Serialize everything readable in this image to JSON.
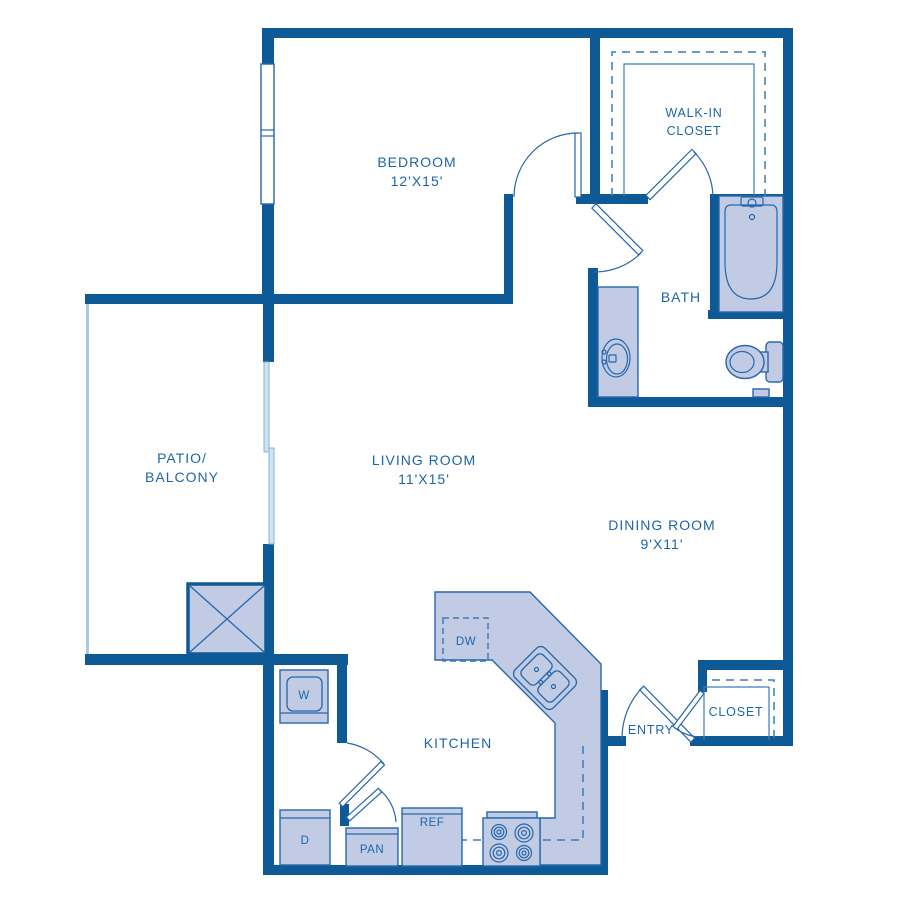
{
  "plan_title": "One bedroom apartment floor plan",
  "colors": {
    "wall": "#0e5a96",
    "fixture_fill": "#c1cbe4",
    "fixture_stroke": "#2767ab",
    "label_text": "#1c66ab",
    "dashed_line": "#3f7cb6",
    "railing": "#abc8de",
    "glass": "#cfe3f2",
    "glass_edge": "#86b3d2"
  },
  "rooms": {
    "bedroom": {
      "name": "BEDROOM",
      "dims": "12'X15'"
    },
    "walk_in_closet": {
      "line1": "WALK-IN",
      "line2": "CLOSET"
    },
    "bath": {
      "name": "BATH"
    },
    "patio": {
      "line1": "PATIO/",
      "line2": "BALCONY"
    },
    "living_room": {
      "name": "LIVING ROOM",
      "dims": "11'X15'"
    },
    "dining_room": {
      "name": "DINING ROOM",
      "dims": "9'X11'"
    },
    "kitchen": {
      "name": "KITCHEN"
    },
    "entry": {
      "name": "ENTRY"
    },
    "closet": {
      "name": "CLOSET"
    }
  },
  "appliances": {
    "washer": "W",
    "dryer": "D",
    "pantry": "PAN",
    "refrigerator": "REF",
    "dishwasher": "DW"
  }
}
